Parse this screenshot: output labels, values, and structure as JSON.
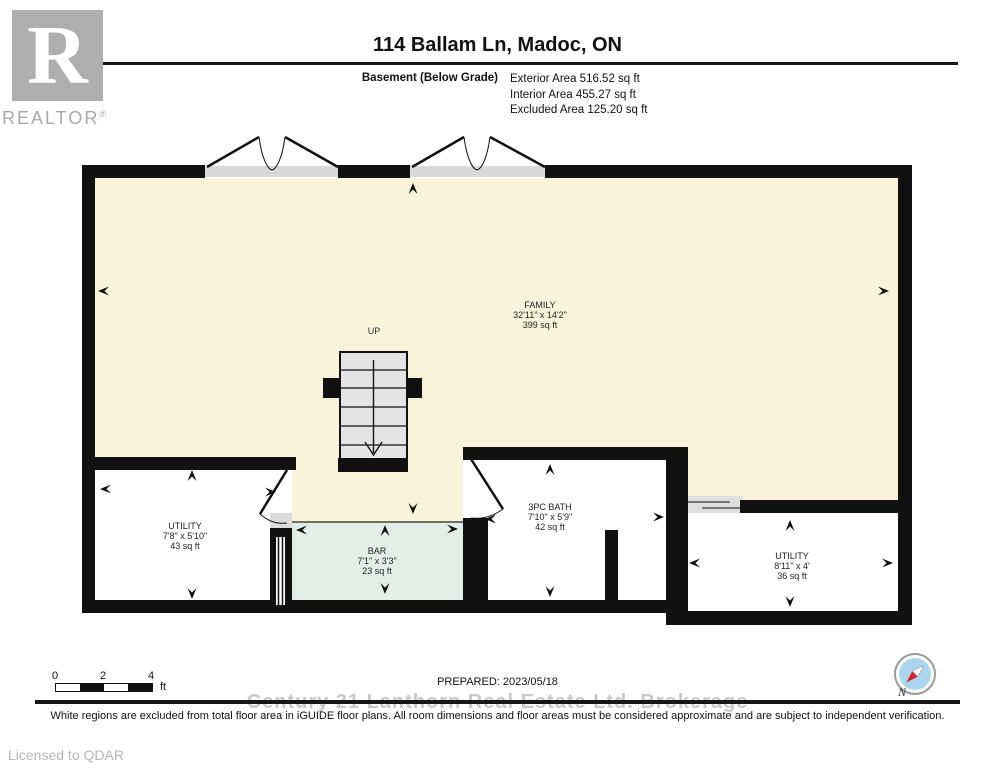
{
  "logo": {
    "letter": "R",
    "wordmark": "REALTOR",
    "registered": "®"
  },
  "header": {
    "title": "114 Ballam Ln, Madoc, ON",
    "floor_label": "Basement (Below Grade)",
    "areas": [
      {
        "label": "Exterior Area 516.52 sq ft"
      },
      {
        "label": "Interior Area 455.27 sq ft"
      },
      {
        "label": "Excluded Area 125.20 sq ft"
      }
    ]
  },
  "plan": {
    "stairs_label": "UP",
    "rooms": [
      {
        "name": "FAMILY",
        "dims": "32'11\" x 14'2\"",
        "area": "399 sq ft"
      },
      {
        "name": "UTILITY",
        "dims": "7'8\" x 5'10\"",
        "area": "43 sq ft"
      },
      {
        "name": "BAR",
        "dims": "7'1\" x 3'3\"",
        "area": "23 sq ft"
      },
      {
        "name": "3PC BATH",
        "dims": "7'10\" x 5'9\"",
        "area": "42 sq ft"
      },
      {
        "name": "UTILITY",
        "dims": "8'11\" x 4'",
        "area": "36 sq ft"
      }
    ],
    "colors": {
      "included_floor": "#FAF3DC",
      "bar_floor": "#E3EEE8",
      "excluded_floor": "#FFFFFF",
      "wall": "#111111",
      "opening": "#D9D9D9",
      "stairs": "#E4E4E4"
    }
  },
  "footer": {
    "scale": {
      "ticks": [
        "0",
        "2",
        "4"
      ],
      "unit": "ft"
    },
    "prepared": "PREPARED: 2023/05/18",
    "watermark": "Century 21 Lanthorn Real Estate Ltd. Brokerage",
    "disclaimer": "White regions are excluded from total floor area in iGUIDE floor plans. All room dimensions and floor areas must be considered approximate and are subject to independent verification.",
    "licensed": "Licensed to QDAR",
    "compass_label": "N"
  }
}
